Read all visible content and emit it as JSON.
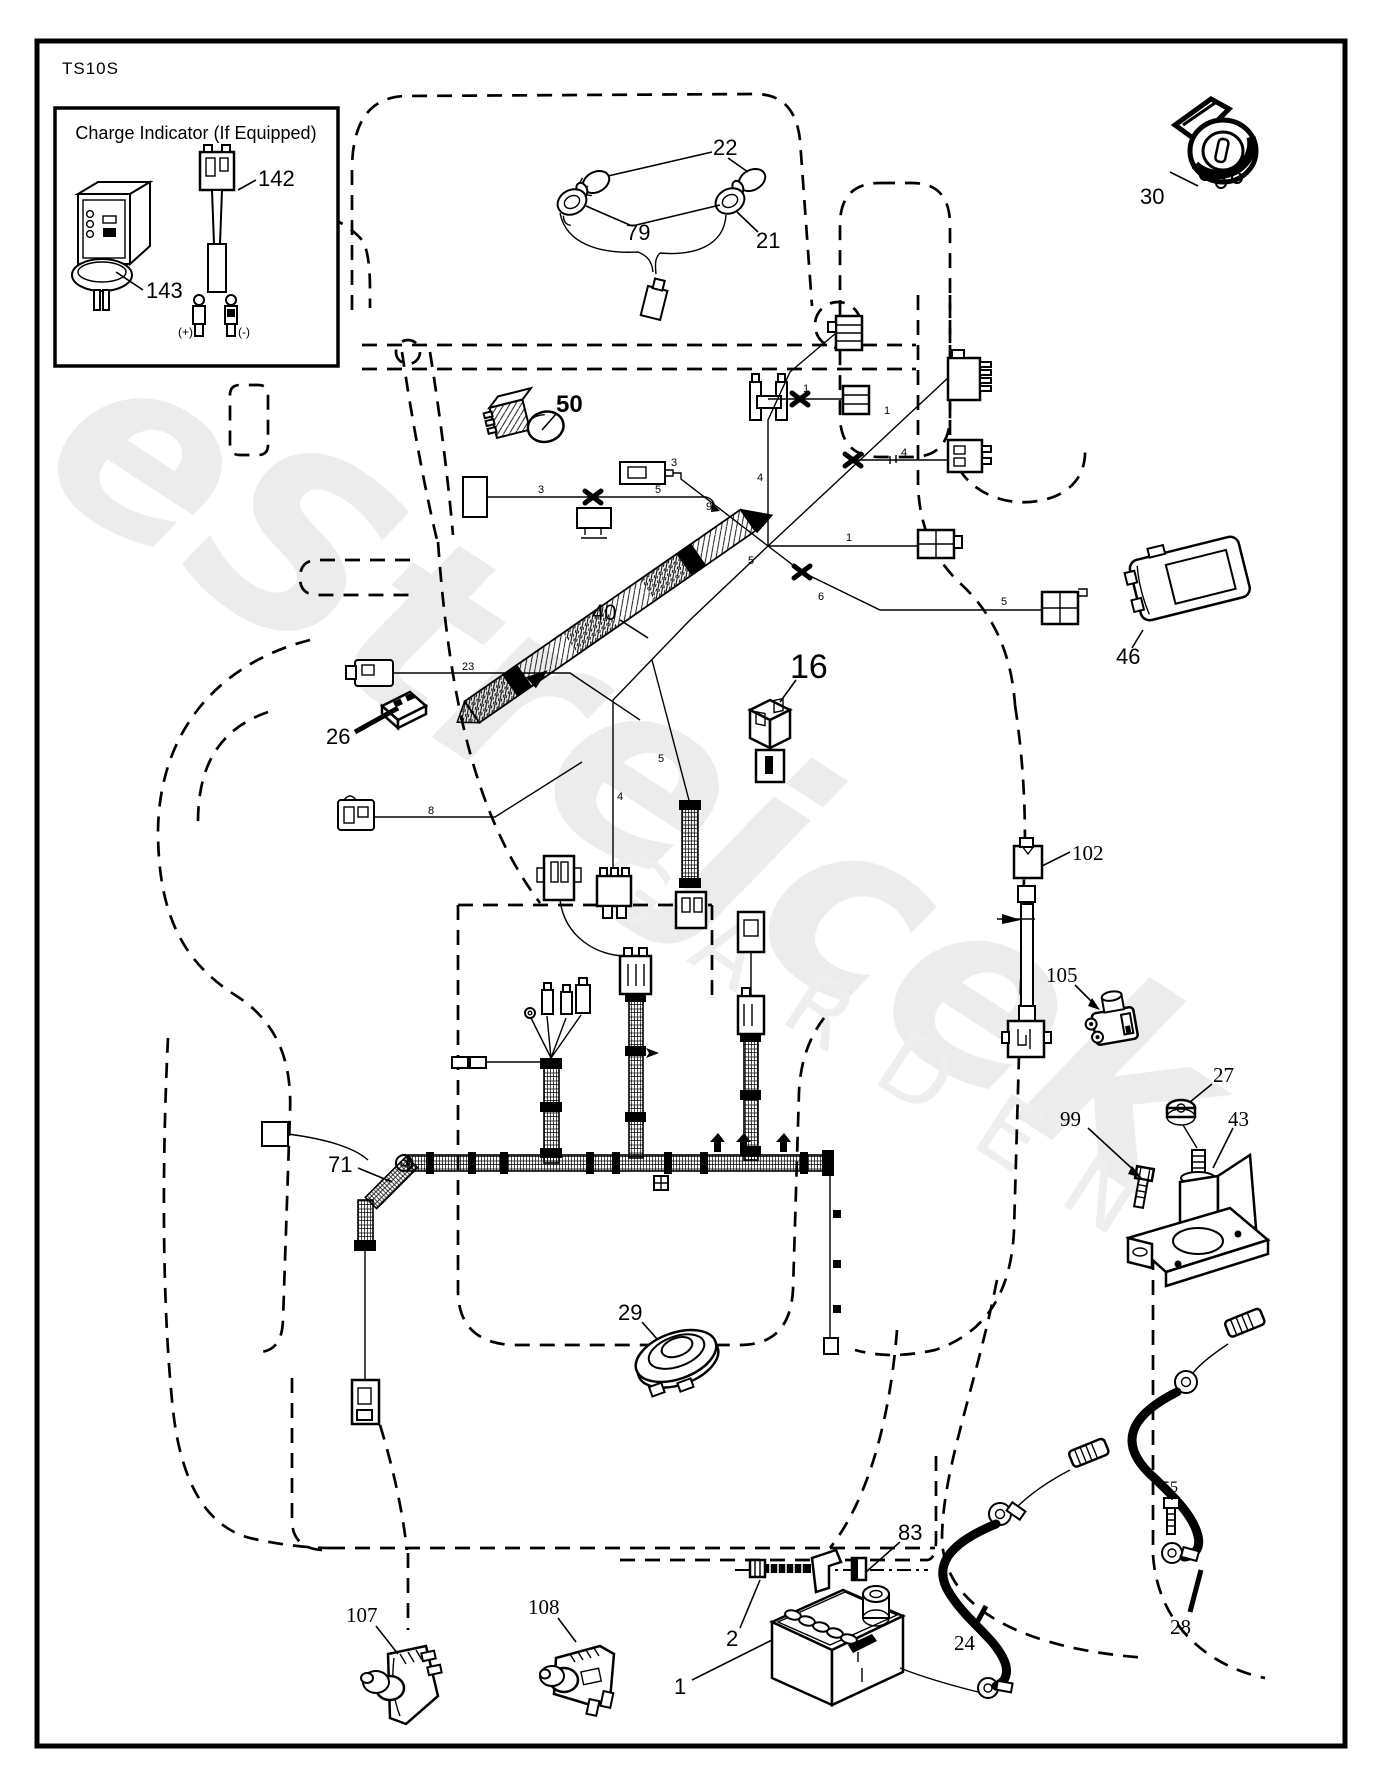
{
  "page": {
    "model": "TS10S"
  },
  "watermark": {
    "primary": "eStrejcek",
    "secondary": "GARDEN"
  },
  "inset": {
    "title": "Charge Indicator (If Equipped)",
    "indicator_label": "143",
    "connector_label": "142",
    "positive": "(+)",
    "negative": "(-)"
  },
  "parts": [
    {
      "id": "22"
    },
    {
      "id": "79"
    },
    {
      "id": "21"
    },
    {
      "id": "30"
    },
    {
      "id": "50"
    },
    {
      "id": "40"
    },
    {
      "id": "16"
    },
    {
      "id": "26"
    },
    {
      "id": "46"
    },
    {
      "id": "102"
    },
    {
      "id": "105"
    },
    {
      "id": "27"
    },
    {
      "id": "43"
    },
    {
      "id": "99"
    },
    {
      "id": "71"
    },
    {
      "id": "29"
    },
    {
      "id": "83"
    },
    {
      "id": "2"
    },
    {
      "id": "1"
    },
    {
      "id": "107"
    },
    {
      "id": "108"
    },
    {
      "id": "24"
    },
    {
      "id": "28"
    },
    {
      "id": "55"
    }
  ],
  "wires": [
    "3",
    "5",
    "3",
    "23",
    "8",
    "4",
    "5",
    "5",
    "4",
    "1",
    "4",
    "1",
    "6",
    "5",
    "9",
    "1"
  ]
}
